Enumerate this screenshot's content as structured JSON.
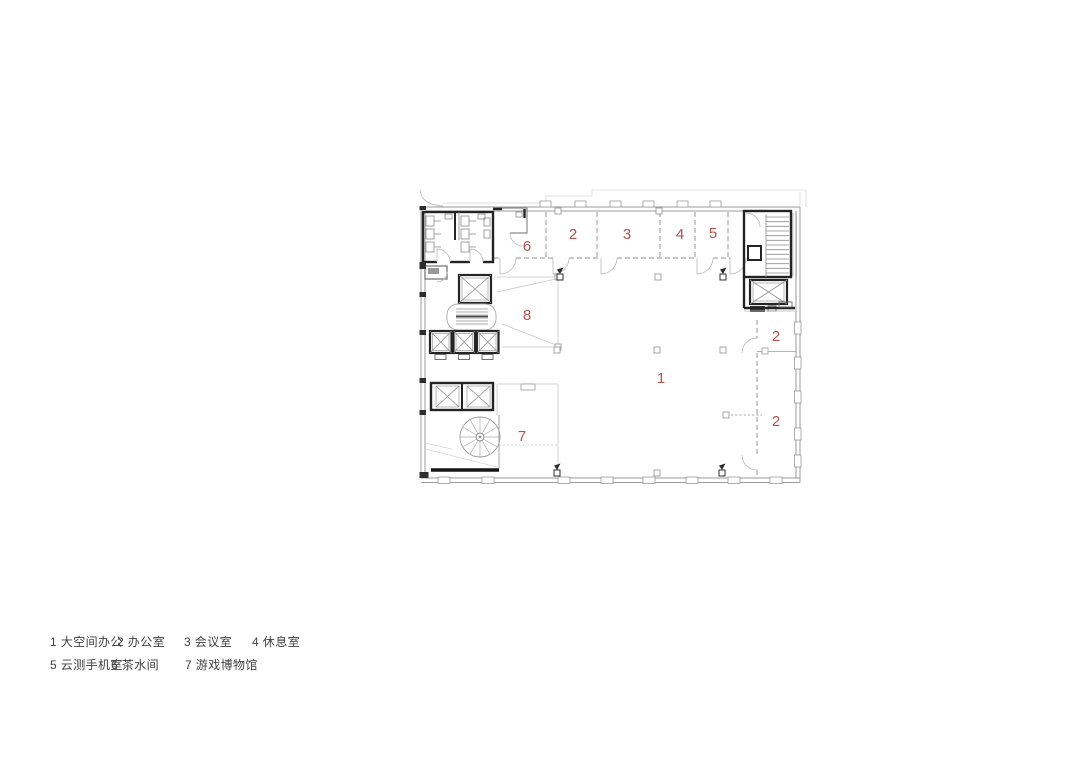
{
  "canvas": {
    "background": "#ffffff",
    "width": 1080,
    "height": 764
  },
  "plan": {
    "type": "architectural-floor-plan",
    "accent_color": "#b0524d",
    "wall_color": "#9b9b9b",
    "core_wall_color": "#242424",
    "room_labels": [
      {
        "number": "6"
      },
      {
        "number": "2"
      },
      {
        "number": "3"
      },
      {
        "number": "4"
      },
      {
        "number": "5"
      },
      {
        "number": "8"
      },
      {
        "number": "1"
      },
      {
        "number": "2"
      },
      {
        "number": "2"
      },
      {
        "number": "7"
      }
    ]
  },
  "legend": {
    "row1": [
      {
        "text": "1 大空间办公"
      },
      {
        "text": "2 办公室"
      },
      {
        "text": "3 会议室"
      },
      {
        "text": "4 休息室"
      }
    ],
    "row2": [
      {
        "text": "5 云测手机室"
      },
      {
        "text": "6 茶水间"
      },
      {
        "text": "7 游戏博物馆"
      }
    ]
  }
}
